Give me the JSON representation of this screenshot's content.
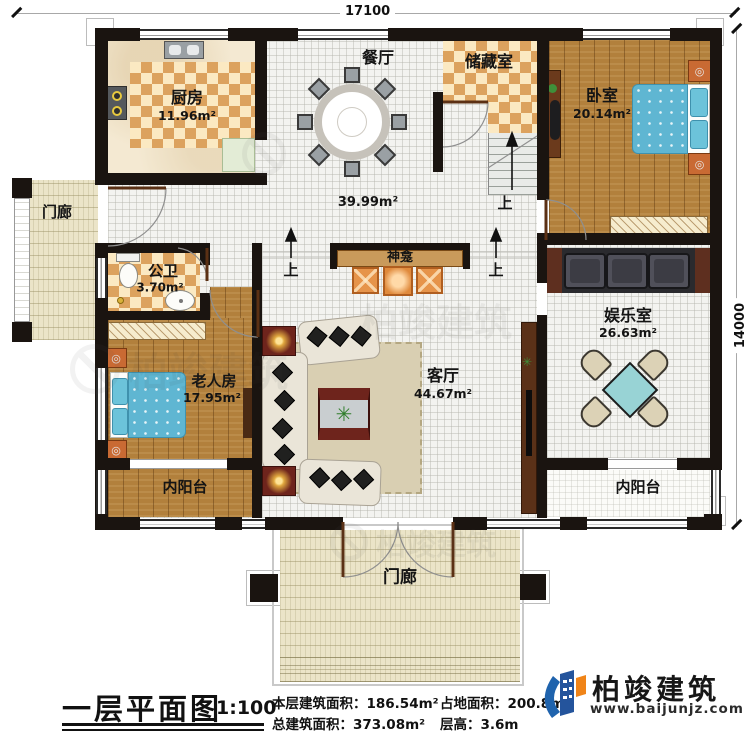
{
  "dimensions": {
    "top": "17100",
    "right": "14000"
  },
  "rooms": {
    "kitchen": {
      "name": "厨房",
      "area": "11.96m²"
    },
    "dining": {
      "name": "餐厅"
    },
    "hall": {
      "area": "39.99m²"
    },
    "storage": {
      "name": "储藏室"
    },
    "bedroom": {
      "name": "卧室",
      "area": "20.14m²"
    },
    "bathroom": {
      "name": "公卫",
      "area": "3.70m²"
    },
    "elder_room": {
      "name": "老人房",
      "area": "17.95m²"
    },
    "living": {
      "name": "客厅",
      "area": "44.67m²"
    },
    "entertainment": {
      "name": "娱乐室",
      "area": "26.63m²"
    },
    "balcony_left": {
      "name": "内阳台"
    },
    "balcony_right": {
      "name": "内阳台"
    },
    "porch_left": {
      "name": "门廊"
    },
    "porch_bottom": {
      "name": "门廊"
    },
    "shrine": {
      "name": "神龛"
    },
    "stairs_up": {
      "label": "上"
    }
  },
  "title_block": {
    "plan_title": "一层平面图",
    "scale": "1:100",
    "stats": [
      {
        "label": "本层建筑面积：",
        "value": "186.54m²"
      },
      {
        "label": "总建筑面积：",
        "value": "373.08m²"
      },
      {
        "label": "占地面积：",
        "value": "200.8m²"
      },
      {
        "label": "层高：",
        "value": "3.6m"
      }
    ]
  },
  "branding": {
    "company": "柏竣建筑",
    "website": "www.baijunjz.com",
    "watermark": "柏竣建筑"
  },
  "colors": {
    "wall": "#1a1410",
    "checker_floor": "#dca25e",
    "wood_floor": "#b2803c",
    "bed_blue": "#5fb6d2",
    "shrine_orange": "#e6944a",
    "logo_blue": "#1f63ad",
    "logo_orange": "#f08418"
  }
}
